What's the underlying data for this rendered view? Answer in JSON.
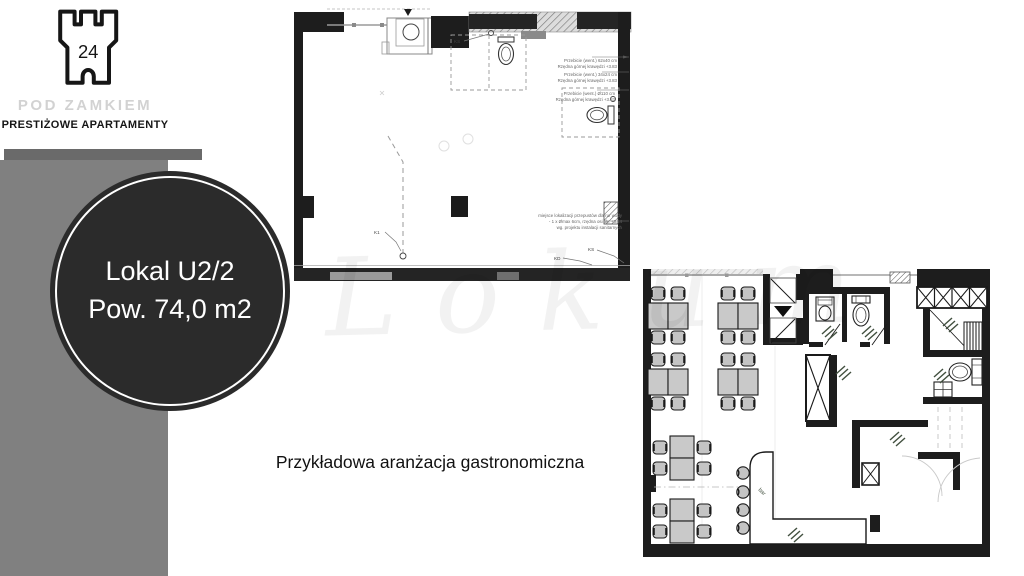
{
  "branding": {
    "logo_number": "24",
    "logo_name": "POD ZAMKIEM",
    "logo_tagline": "PRESTIŻOWE APARTAMENTY"
  },
  "unit_badge": {
    "line1": "Lokal U2/2",
    "line2": "Pow. 74,0 m2"
  },
  "caption": "Przykładowa aranżacja gastronomiczna",
  "watermark": "Lokum",
  "plan_technical": {
    "annotations": {
      "vent1_line1": "Przebicie (went.) 62x40 cm",
      "vent1_line2": "Rzędna górnej krawędzi +3.83",
      "vent2_line1": "Przebicie (went.) 34x24 cm",
      "vent2_line2": "Rzędna górnej krawędzi +3.83",
      "vent3_line1": "Przebicie (went.) Ø110 cm",
      "vent3_line2": "Rzędna górnej krawędzi +3.83",
      "water_line1": "miejsce lokalizacji przepustów dla rur wody",
      "water_line2": "- 1 x Ømax 6cm, rzędna osi ok. +3.14",
      "water_line3": "wg. projektu instalacji sanitarnych",
      "label_ks_top": "KS",
      "label_k1": "K1",
      "label_kd": "KD",
      "label_ks_bottom": "KS"
    }
  },
  "plan_furnished": {
    "label_bar": "bar"
  },
  "colors": {
    "sidebar_gray": "#808080",
    "badge_dark": "#2b2b2b",
    "wall_black": "#1d1d1d",
    "furniture_gray": "#c9c9c9"
  }
}
